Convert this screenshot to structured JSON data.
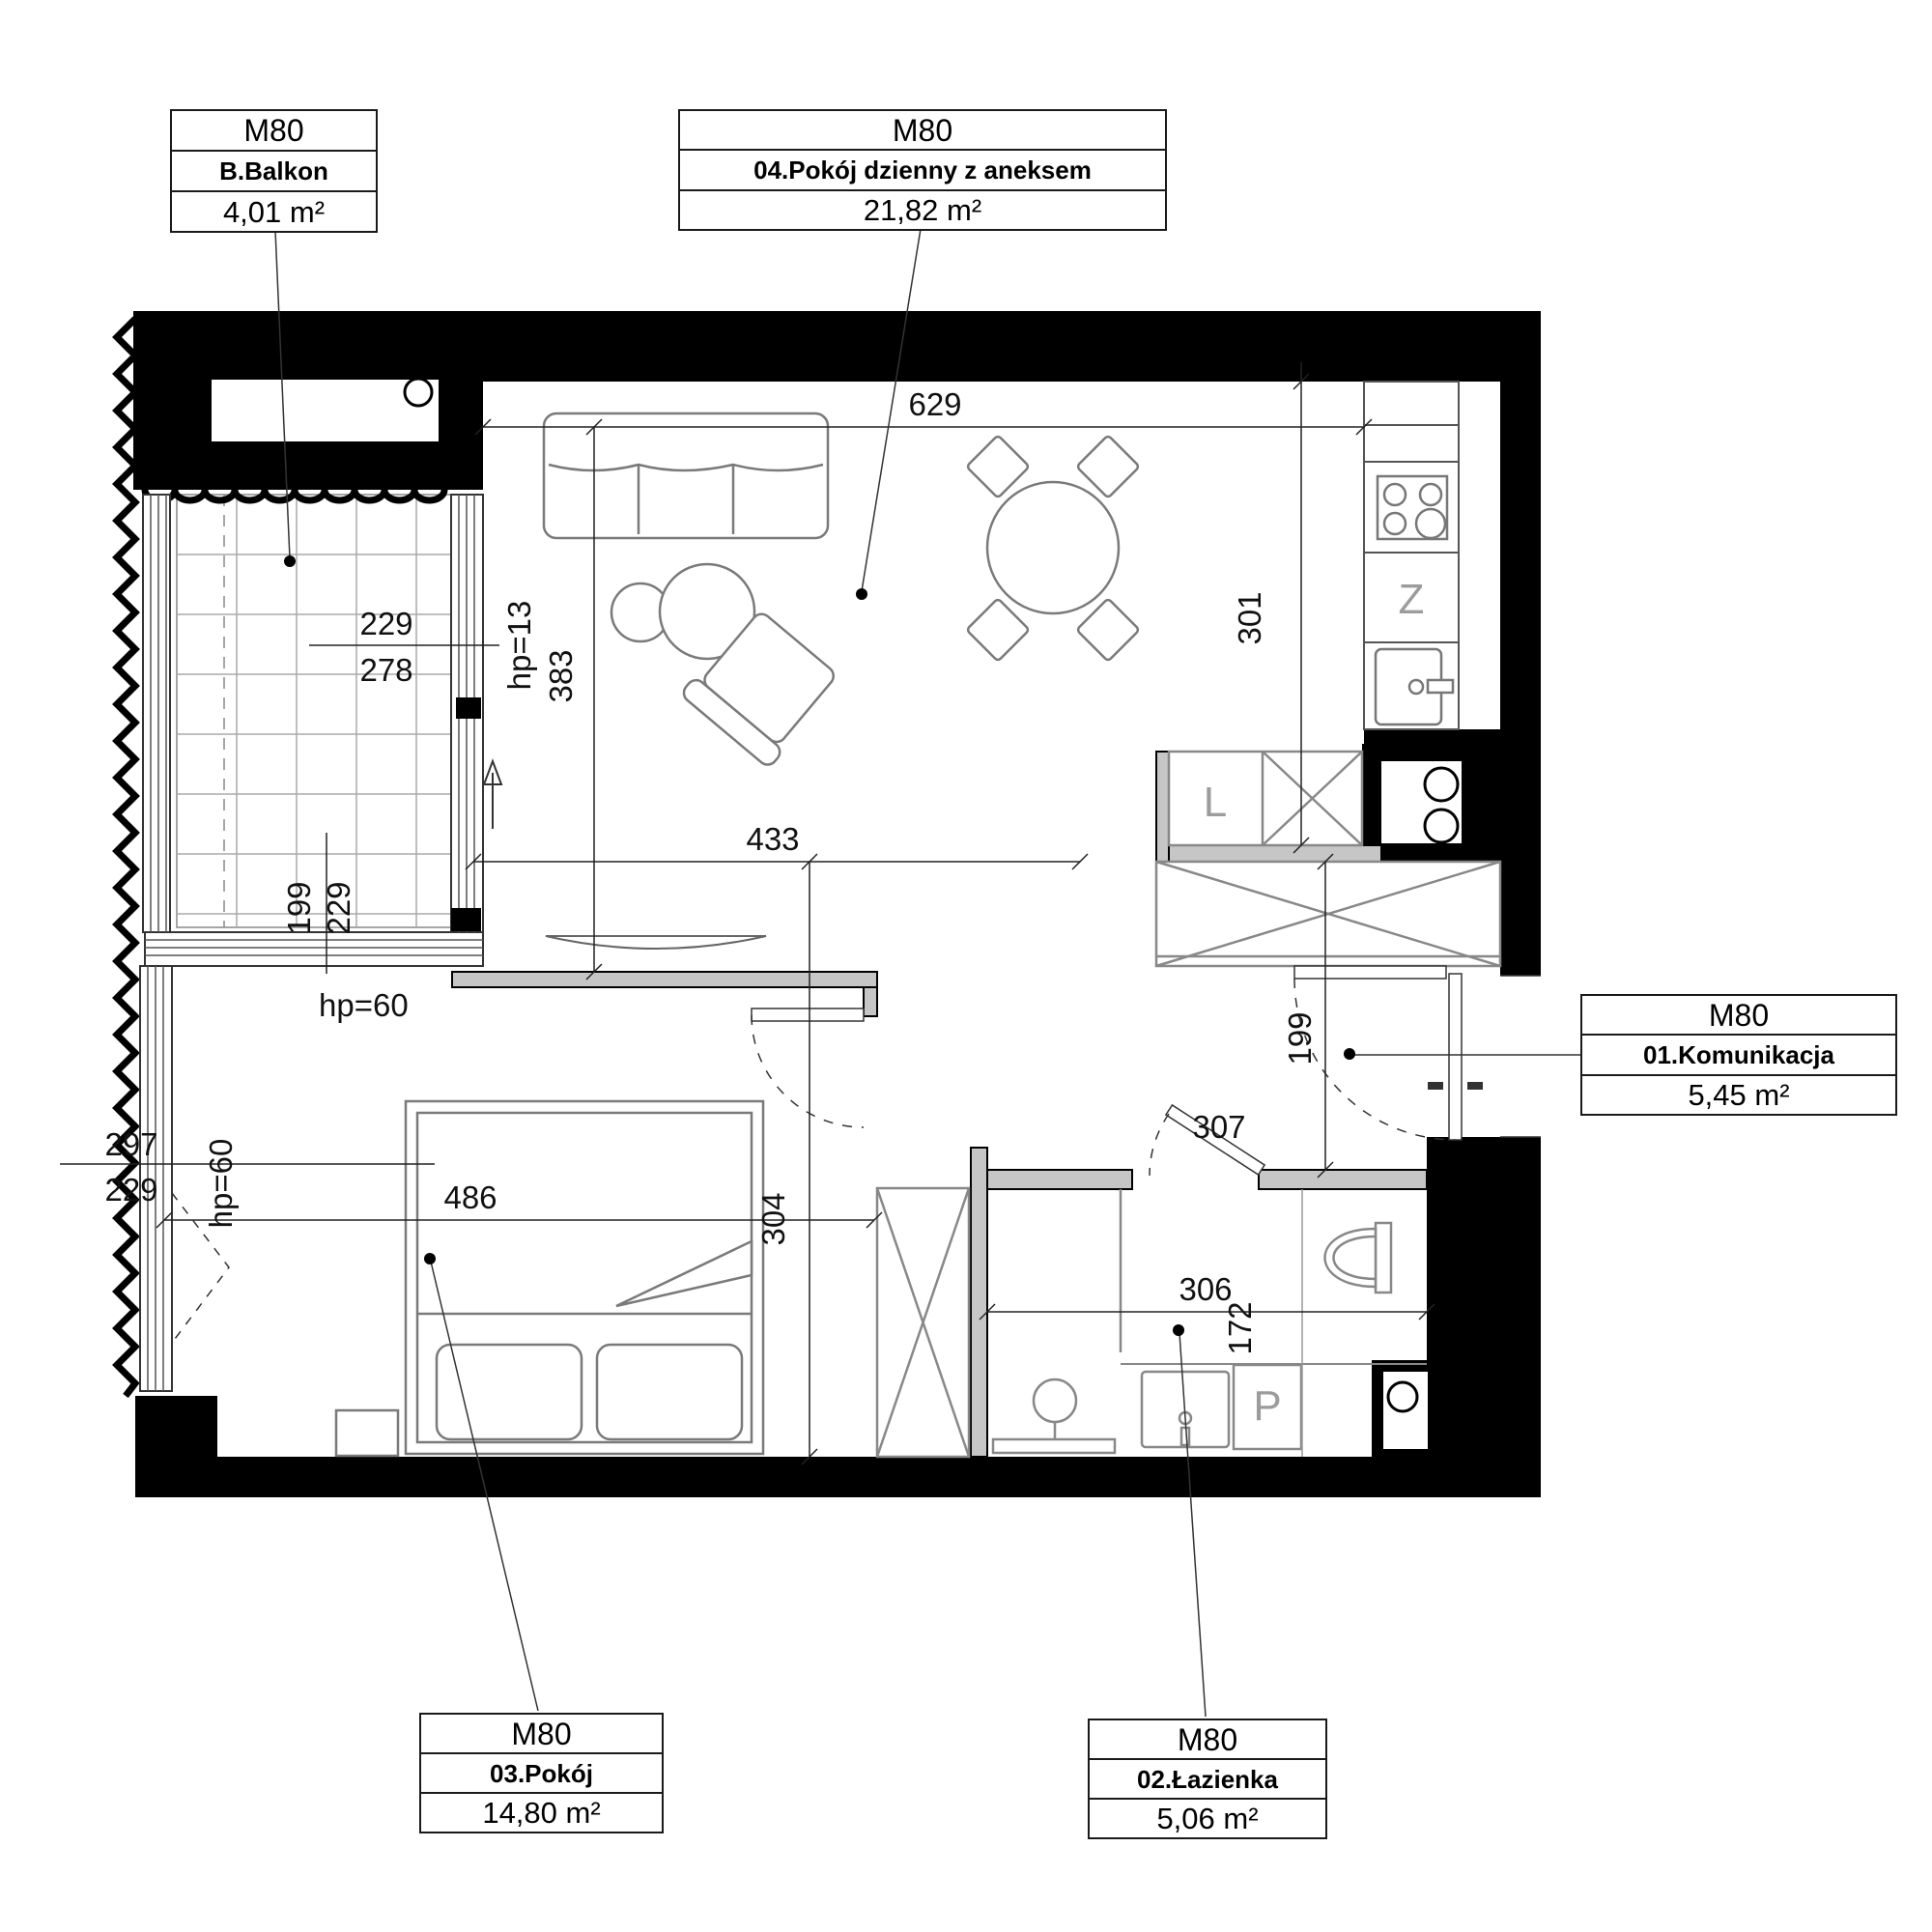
{
  "page": {
    "background": "#ffffff"
  },
  "unit_labels": [
    {
      "code": "M80",
      "name": "B.Balkon",
      "area": "4,01 m²"
    },
    {
      "code": "M80",
      "name": "04.Pokój dzienny z aneksem",
      "area": "21,82 m²"
    },
    {
      "code": "M80",
      "name": "01.Komunikacja",
      "area": "5,45 m²"
    },
    {
      "code": "M80",
      "name": "03.Pokój",
      "area": "14,80 m²"
    },
    {
      "code": "M80",
      "name": "02.Łazienka",
      "area": "5,06 m²"
    }
  ],
  "dimensions": {
    "living_width": "629",
    "living_depth": "383",
    "balcony_door_sill": "hp=13",
    "kitchen_wall": "301",
    "living_lower_width": "433",
    "hall_depth": "304",
    "bedroom_width": "486",
    "bedroom_sill_north": "hp=60",
    "bedroom_sill_west": "hp=60",
    "bedroom_window_outer": "297",
    "bedroom_window_inner": "229",
    "balcony_width_inner": "229",
    "balcony_width_outer": "278",
    "balcony_depth_inner": "199",
    "balcony_depth_outer": "229",
    "entry_clearance": "199",
    "bath_door": "307",
    "bath_width": "306",
    "bath_depth": "172"
  },
  "appliances": {
    "fridge": "L",
    "dishwasher": "Z",
    "washer": "P"
  },
  "colors": {
    "wall": "#000000",
    "partition": "#c6c6c6",
    "furniture": "#7a7a7a",
    "dimension_text": "#111111"
  }
}
